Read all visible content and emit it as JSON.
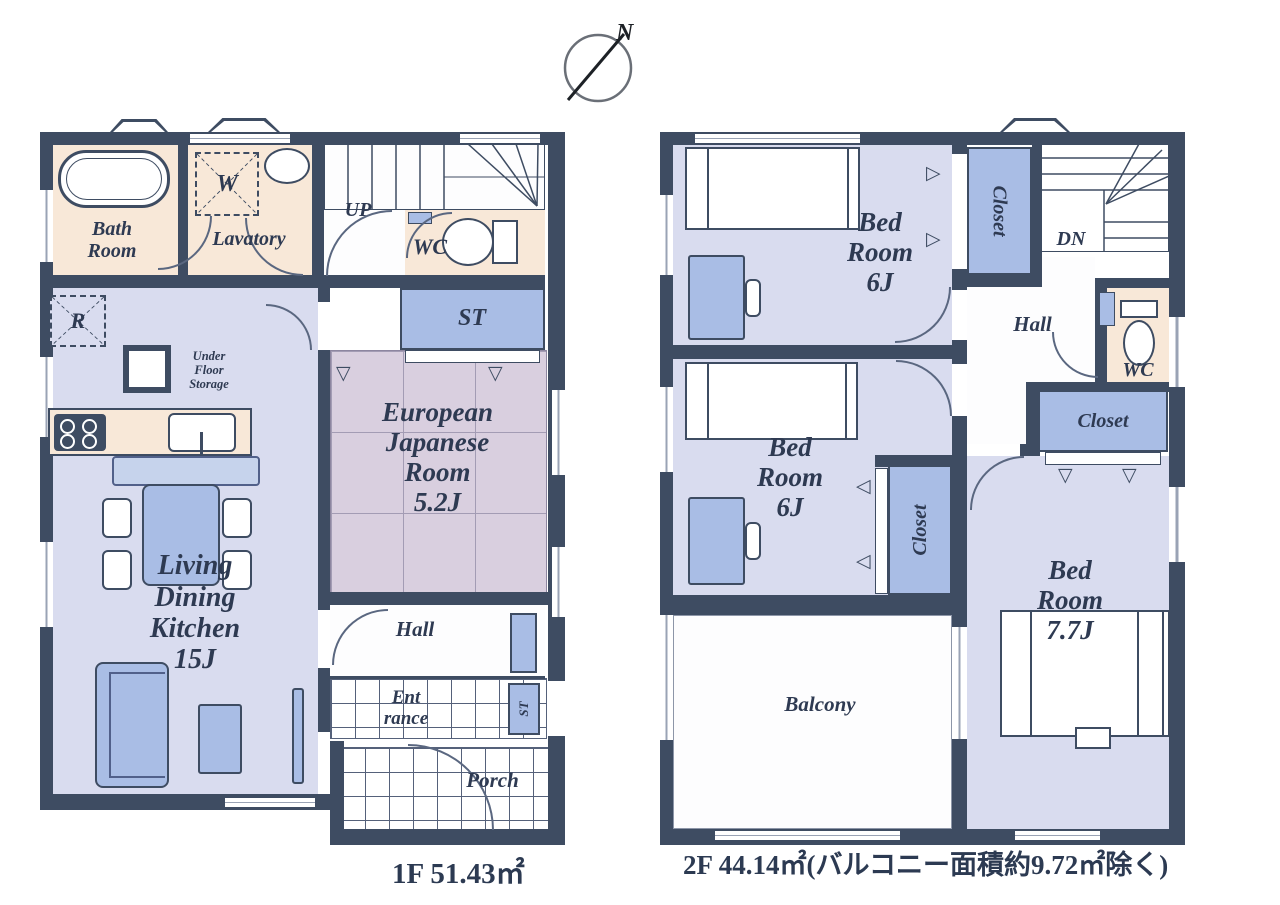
{
  "compass": {
    "north_label": "N"
  },
  "floor1": {
    "area_label": "1F 51.43㎡",
    "labels": {
      "bath": "Bath\nRoom",
      "lavatory": "Lavatory",
      "washer": "W",
      "fridge": "R",
      "up": "UP",
      "wc": "WC",
      "st": "ST",
      "japanese_room": "European\nJapanese\nRoom\n5.2J",
      "under_floor": "Under\nFloor\nStorage",
      "ldk": "Living\nDining\nKitchen\n15J",
      "hall": "Hall",
      "entrance": "Ent\nrance",
      "st_small": "ST",
      "porch": "Porch"
    }
  },
  "floor2": {
    "area_label": "2F 44.14㎡(バルコニー面積約9.72㎡除く)",
    "labels": {
      "bedroom_top": "Bed\nRoom\n6J",
      "closet_top": "Closet",
      "dn": "DN",
      "hall": "Hall",
      "wc": "WC",
      "closet_right": "Closet",
      "bedroom_mid": "Bed\nRoom\n6J",
      "closet_mid": "Closet",
      "bedroom_large": "Bed\nRoom\n7.7J",
      "balcony": "Balcony"
    }
  },
  "colors": {
    "wall": "#3e4c62",
    "room_floor": "#d9dcef",
    "tatami_floor": "#d9cfdf",
    "wet_floor": "#f8e8d8",
    "furniture_blue": "#a9bde5",
    "text": "#2e3a52"
  }
}
